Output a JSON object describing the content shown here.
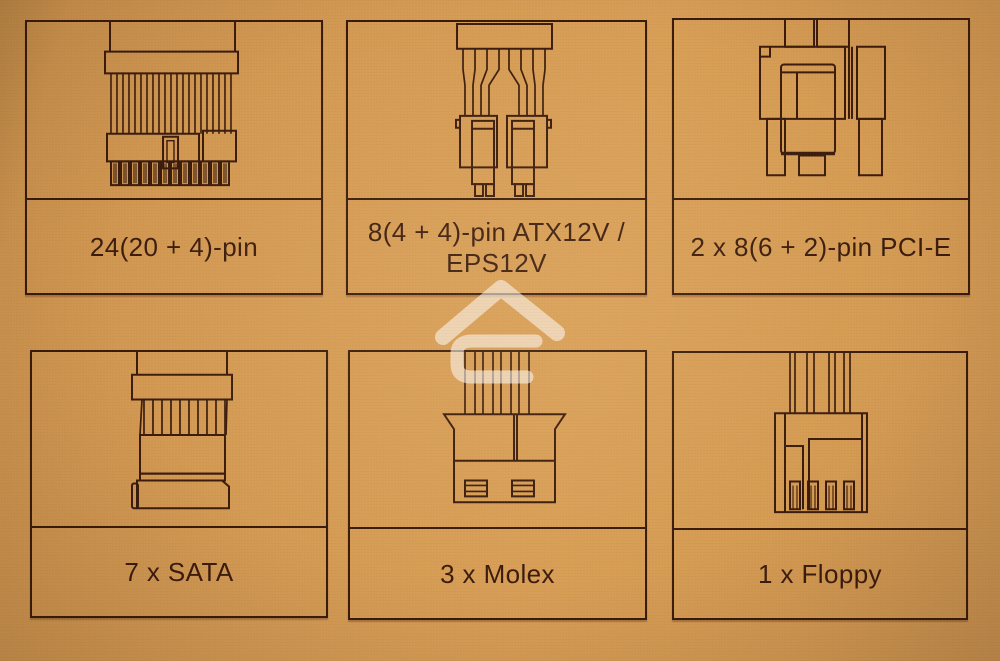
{
  "palette": {
    "bg": "#d2994f",
    "ink": "#3a1b0c",
    "border": "#381a0b",
    "watermark": "#ffffff"
  },
  "watermark": {
    "icon": "house-logo-watermark-icon"
  },
  "cells": [
    {
      "id": "24pin",
      "icon": "atx-24pin-connector-icon",
      "label_lines": [
        "24(20 + 4)-pin"
      ]
    },
    {
      "id": "eps",
      "icon": "eps-8pin-connector-icon",
      "label_lines": [
        "8(4 + 4)-pin ATX12V /",
        "EPS12V"
      ]
    },
    {
      "id": "pcie",
      "icon": "pcie-8pin-connector-icon",
      "label_lines": [
        "2 x 8(6 + 2)-pin PCI-E"
      ]
    },
    {
      "id": "sata",
      "icon": "sata-connector-icon",
      "label_lines": [
        "7 x SATA"
      ]
    },
    {
      "id": "molex",
      "icon": "molex-connector-icon",
      "label_lines": [
        "3 x Molex"
      ]
    },
    {
      "id": "floppy",
      "icon": "floppy-connector-icon",
      "label_lines": [
        "1 x Floppy"
      ]
    }
  ]
}
